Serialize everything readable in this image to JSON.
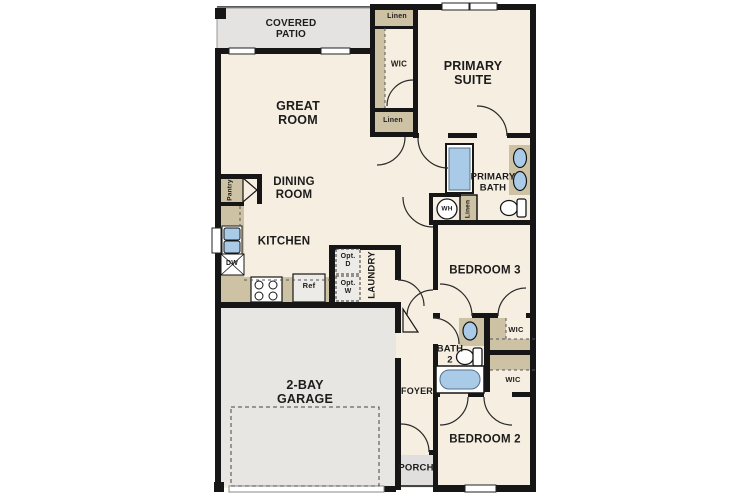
{
  "plan_title": "single-story floor plan",
  "colors": {
    "wall": "#161616",
    "floor": "#f6efe1",
    "outdoor": "#e4e3e1",
    "garage_floor": "#e7e6e3",
    "counter": "#cec2a5",
    "fixture_blue": "#a9cbe7",
    "appliance": "#edebe7"
  },
  "rooms": {
    "covered_patio": "COVERED PATIO",
    "great_room": "GREAT ROOM",
    "dining_room": "DINING ROOM",
    "kitchen": "KITCHEN",
    "primary_suite": "PRIMARY SUITE",
    "primary_bath": "PRIMARY BATH",
    "bedroom_3": "BEDROOM 3",
    "bedroom_2": "BEDROOM 2",
    "bath_2": "BATH 2",
    "laundry": "LAUNDRY",
    "foyer": "FOYER",
    "porch": "PORCH",
    "garage": "2-BAY GARAGE"
  },
  "closets": {
    "linen_top": "Linen",
    "linen_mid": "Linen",
    "linen_bath": "Linen",
    "wic_primary": "WIC",
    "wic_bedroom3": "WIC",
    "wic_bedroom2": "WIC",
    "pantry": "Pantry"
  },
  "appliances": {
    "dishwasher": "DW",
    "refrigerator": "Ref",
    "water_heater": "WH",
    "optional_dryer": "Opt. D",
    "optional_washer": "Opt. W"
  }
}
